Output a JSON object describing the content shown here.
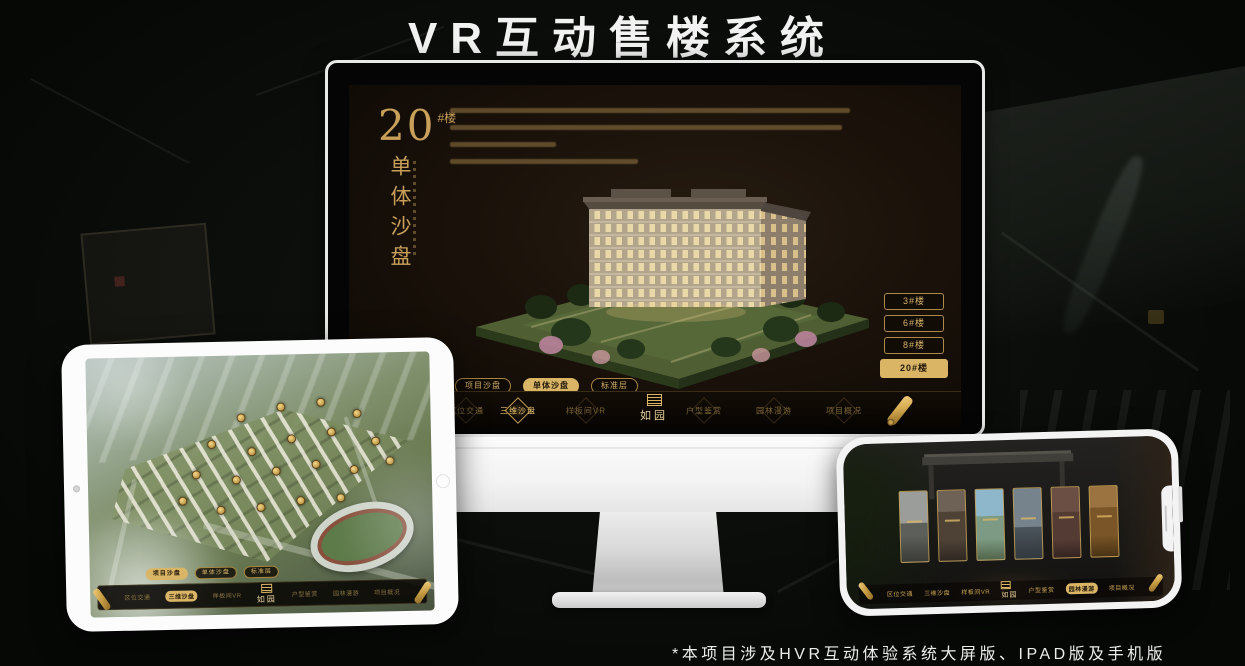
{
  "title": "VR互动售楼系统",
  "footnote": "*本项目涉及HVR互动体验系统大屏版、IPAD版及手机版",
  "colors": {
    "gold": "#d9b565",
    "gold_dim": "#7a6436",
    "screen_bg": "#181009",
    "nav_bg": "#0b0703",
    "chrome_white": "#f2f2f2"
  },
  "monitor": {
    "headline_number": "20",
    "headline_suffix": "#楼",
    "headline_vertical": "单体沙盘",
    "floor_buttons": [
      {
        "label": "3#楼",
        "active": false
      },
      {
        "label": "6#楼",
        "active": false
      },
      {
        "label": "8#楼",
        "active": false
      },
      {
        "label": "20#楼",
        "active": true
      }
    ],
    "tabs": [
      {
        "label": "项目沙盘",
        "active": false
      },
      {
        "label": "单体沙盘",
        "active": true
      },
      {
        "label": "标准层",
        "active": false
      }
    ],
    "nav": {
      "logo": "如园",
      "items": [
        {
          "label": "区位交通",
          "active": false
        },
        {
          "label": "三维沙盘",
          "active": true
        },
        {
          "label": "样板间VR",
          "active": false
        },
        {
          "label": "户型鉴赏",
          "active": false
        },
        {
          "label": "园林漫游",
          "active": false
        },
        {
          "label": "项目概况",
          "active": false
        }
      ]
    }
  },
  "ipad": {
    "tabs": [
      {
        "label": "项目沙盘",
        "active": true
      },
      {
        "label": "单体沙盘",
        "active": false
      },
      {
        "label": "标准层",
        "active": false
      }
    ],
    "nav": {
      "logo": "如园",
      "items": [
        {
          "label": "区位交通",
          "active": false
        },
        {
          "label": "三维沙盘",
          "active": true
        },
        {
          "label": "样板间VR",
          "active": false
        },
        {
          "label": "户型鉴赏",
          "active": false
        },
        {
          "label": "园林漫游",
          "active": false
        },
        {
          "label": "项目概况",
          "active": false
        }
      ]
    }
  },
  "phone": {
    "nav": {
      "logo": "如园",
      "items": [
        {
          "label": "区位交通",
          "active": false
        },
        {
          "label": "三维沙盘",
          "active": false
        },
        {
          "label": "样板间VR",
          "active": false
        },
        {
          "label": "户型鉴赏",
          "active": false
        },
        {
          "label": "园林漫游",
          "active": true
        },
        {
          "label": "项目概况",
          "active": false
        }
      ]
    }
  }
}
